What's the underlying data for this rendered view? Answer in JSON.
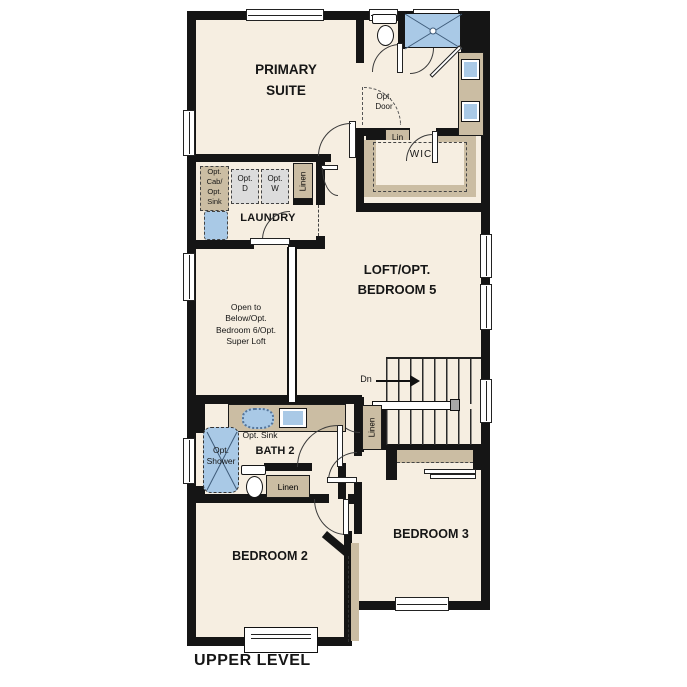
{
  "title": "UPPER LEVEL",
  "rooms": {
    "primary_suite": {
      "line1": "PRIMARY",
      "line2": "SUITE"
    },
    "wic": "WIC",
    "laundry": "LAUNDRY",
    "loft_bedroom5": {
      "line1": "LOFT/OPT.",
      "line2": "BEDROOM 5"
    },
    "open_to_below": {
      "line1": "Open to",
      "line2": "Below/Opt.",
      "line3": "Bedroom 6/Opt.",
      "line4": "Super Loft"
    },
    "bath2": "BATH 2",
    "bedroom2": "BEDROOM 2",
    "bedroom3": "BEDROOM 3"
  },
  "labels": {
    "opt_door": {
      "line1": "Opt.",
      "line2": "Door"
    },
    "lin": "Lin",
    "linen_hall": "Linen",
    "linen_stairs": "Linen",
    "linen_bath": "Linen",
    "opt_cab_sink": {
      "line1": "Opt.",
      "line2": "Cab/",
      "line3": "Opt.",
      "line4": "Sink"
    },
    "opt_dryer": {
      "line1": "Opt.",
      "line2": "D"
    },
    "opt_washer": {
      "line1": "Opt.",
      "line2": "W"
    },
    "opt_sink": "Opt. Sink",
    "opt_shower": {
      "line1": "Opt.",
      "line2": "Shower"
    },
    "down": "Dn"
  },
  "colors": {
    "background": "#ffffff",
    "floor": "#f6eee1",
    "wall": "#151515",
    "cabinet": "#cbbda3",
    "fixture_blue": "#a9c9e6",
    "appliance": "#dcdcdc",
    "line": "#3a3a3a"
  }
}
